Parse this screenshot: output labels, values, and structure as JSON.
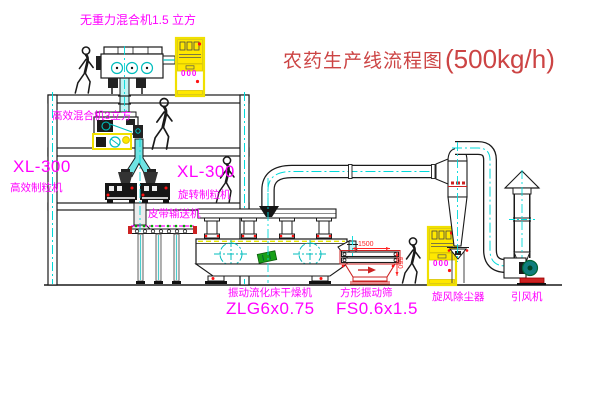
{
  "title": {
    "zh": "农药生产线流程图",
    "capacity": "(500kg/h)"
  },
  "labels": {
    "gravity_mixer": "无重力混合机1.5 立方",
    "mixer_3d": "高效混合机3立方",
    "granulator_left_model": "XL-300",
    "granulator_left_name": "高效制粒机",
    "granulator_right_model": "XL-300",
    "granulator_right_name": "旋转制粒机",
    "belt_conveyor": "皮带输送机",
    "dryer_name": "振动流化床干燥机",
    "dryer_model": "ZLG6x0.75",
    "screen_name": "方形振动筛",
    "screen_model": "FS0.6x1.5",
    "cyclone": "旋风除尘器",
    "fan": "引风机",
    "cabinet_display": "000",
    "dim_length": "1500",
    "dim_height": "550"
  },
  "colors": {
    "label_magenta": "#ff00ff",
    "title_red": "#cc4444",
    "dimension_red": "#ff2222",
    "cabinet_yellow": "#ffe800",
    "pipe_centerline_cyan": "#00cccc",
    "line_black": "#1a1a1a"
  }
}
